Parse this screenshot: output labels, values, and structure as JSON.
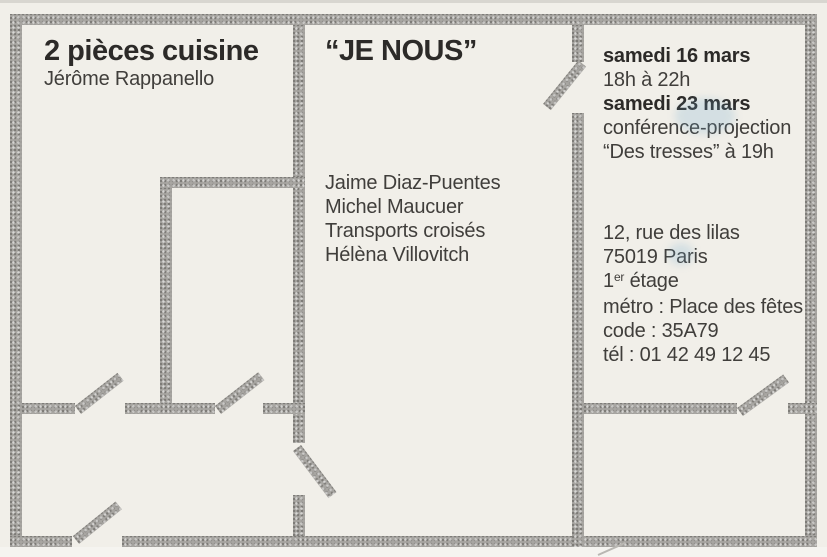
{
  "card": {
    "title": "2 pièces cuisine",
    "author": "Jérôme Rappanello",
    "exhibition_title": "“JE NOUS”",
    "artists": [
      "Jaime Diaz-Puentes",
      "Michel Maucuer",
      "Transports croisés",
      "Hélèna Villovitch"
    ],
    "schedule": {
      "date1": "samedi 16 mars",
      "time1": "18h à 22h",
      "date2": "samedi 23 mars",
      "event2": "conférence-projection",
      "event2_detail": "“Des tresses” à 19h"
    },
    "address": {
      "street": "12, rue des lilas",
      "city": "75019 Paris",
      "floor_num": "1",
      "floor_sup": "er",
      "floor_rest": " étage",
      "metro": "métro : Place des fêtes",
      "door_code": "code : 35A79",
      "phone": "tél : 01 42 49 12 45"
    },
    "colors": {
      "card_background": "#f1efe9",
      "wall_gray": "#a8a6a2",
      "title_text": "#2c2a28",
      "body_text": "#403e3b"
    }
  }
}
